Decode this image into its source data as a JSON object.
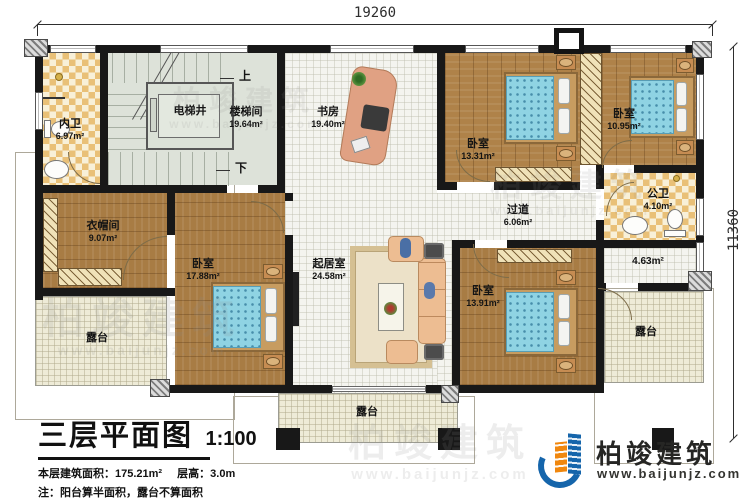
{
  "dimensions": {
    "top": "19260",
    "right": "11360"
  },
  "rooms": {
    "neiwei": {
      "name": "内卫",
      "area": "6.97m²"
    },
    "dianti": {
      "name": "电梯井"
    },
    "louti": {
      "name": "楼梯间",
      "area": "19.64m²"
    },
    "shufang": {
      "name": "书房",
      "area": "19.40m²"
    },
    "woshi_a": {
      "name": "卧室",
      "area": "13.31m²"
    },
    "woshi_b": {
      "name": "卧室",
      "area": "10.95m²"
    },
    "gongwei": {
      "name": "公卫",
      "area": "4.10m²"
    },
    "guodao": {
      "name": "过道",
      "area": "6.06m²"
    },
    "hall": {
      "area": "4.63m²"
    },
    "yimaojian": {
      "name": "衣帽间",
      "area": "9.07m²"
    },
    "woshi_c": {
      "name": "卧室",
      "area": "17.88m²"
    },
    "qijushi": {
      "name": "起居室",
      "area": "24.58m²"
    },
    "woshi_d": {
      "name": "卧室",
      "area": "13.91m²"
    },
    "lutai_left": {
      "name": "露台"
    },
    "lutai_right": {
      "name": "露台"
    },
    "lutai_bottom": {
      "name": "露台"
    }
  },
  "stairs": {
    "up": "上",
    "down": "下"
  },
  "title_block": {
    "title": "三层平面图",
    "scale": "1:100",
    "area_label": "本层建筑面积：175.21m²",
    "floor_height": "层高：3.0m",
    "note": "注：阳台算半面积，露台不算面积"
  },
  "logo": {
    "brand": "柏竣建筑",
    "site": "www.baijunjz.com"
  },
  "watermark": {
    "text": "柏竣建筑",
    "site": "www.baijunjz.com"
  },
  "colors": {
    "wall": "#181818",
    "wood": "#ab7f45",
    "tile_accent": "#e9c077",
    "bed": "#8fd3e3",
    "logo_blue": "#1565ab",
    "logo_orange": "#f0870e"
  }
}
